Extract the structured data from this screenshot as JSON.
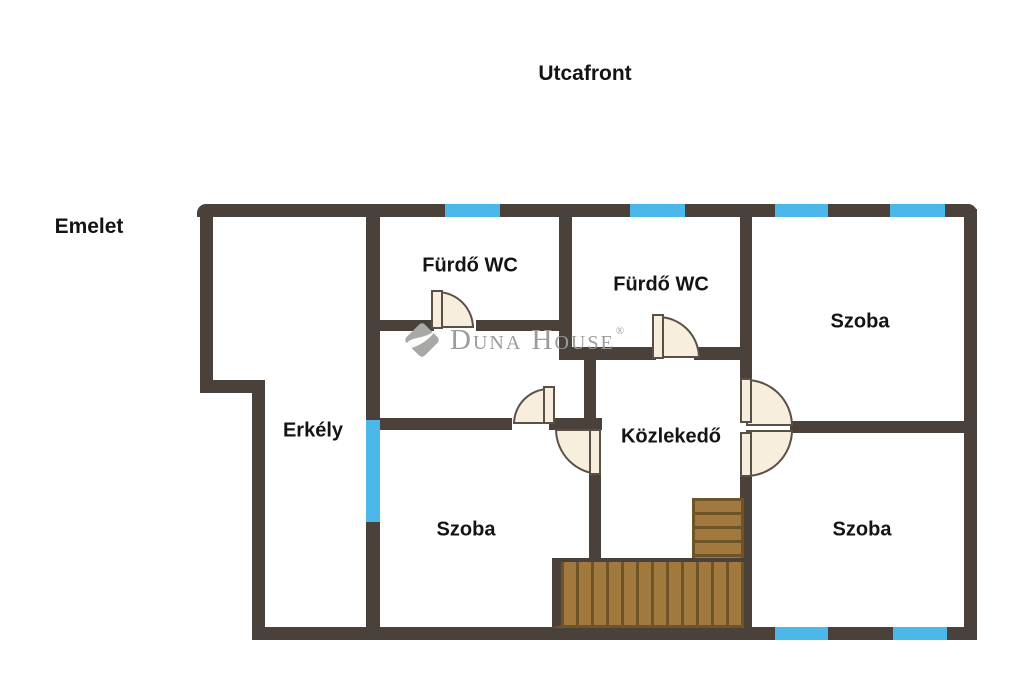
{
  "header": {
    "street_front_label": "Utcafront",
    "floor_label": "Emelet"
  },
  "rooms": [
    {
      "id": "furdo-wc-1",
      "name": "Fürdő WC"
    },
    {
      "id": "furdo-wc-2",
      "name": "Fürdő WC"
    },
    {
      "id": "szoba-top-right",
      "name": "Szoba"
    },
    {
      "id": "erkely",
      "name": "Erkély"
    },
    {
      "id": "kozlekedo",
      "name": "Közlekedő"
    },
    {
      "id": "szoba-bottom-left",
      "name": "Szoba"
    },
    {
      "id": "szoba-bottom-right",
      "name": "Szoba"
    }
  ],
  "watermark": {
    "brand": "Duna House",
    "registered": "®"
  },
  "colors": {
    "wall": "#4a423a",
    "window": "#4cb8ea",
    "door": "#f7eedd",
    "door_outline": "#5a5047",
    "stairs": "#a1793f",
    "stairs_line": "#6e5427",
    "watermark": "#9c9c9a",
    "label": "#141414"
  }
}
